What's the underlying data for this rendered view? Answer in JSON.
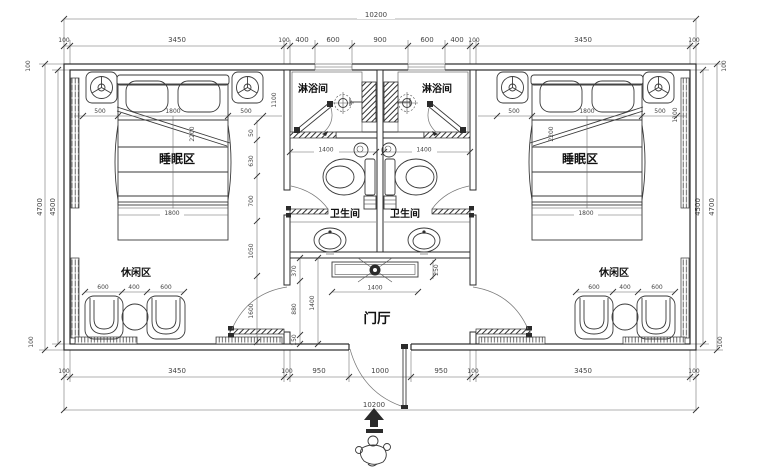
{
  "rooms": {
    "sleeping": "睡眠区",
    "shower": "淋浴间",
    "bathroom": "卫生间",
    "leisure": "休闲区",
    "hall": "门厅"
  },
  "dims": {
    "overall_width": "10200",
    "top": [
      "100",
      "3450",
      "100",
      "400",
      "600",
      "900",
      "600",
      "400",
      "100",
      "3450",
      "100"
    ],
    "bottom": [
      "100",
      "3450",
      "100",
      "950",
      "1000",
      "950",
      "100",
      "3450",
      "100"
    ],
    "left": {
      "outer": "4700",
      "inner": "4500",
      "wall_top": "100",
      "wall_bottom": "100"
    },
    "right": {
      "inner": "4500",
      "outer": "4700",
      "wall_top": "100",
      "wall_bottom": "100"
    },
    "bed": {
      "side": "500",
      "width": "1800",
      "foot_width": "1800",
      "diagonal": "2200",
      "nightstand": "1100"
    },
    "leisure": {
      "chair": "600",
      "table": "400"
    },
    "shower_width": "1400",
    "hall": {
      "depth": "1400",
      "console_width": "1400",
      "console_depth": "250",
      "seg1": "370",
      "seg2": "880",
      "seg3": "150"
    },
    "corridor_chain": [
      "50",
      "630",
      "700",
      "1050",
      "1600"
    ]
  },
  "colors": {
    "line": "#2b2b2b",
    "dim_text": "#444444",
    "background": "#ffffff"
  }
}
